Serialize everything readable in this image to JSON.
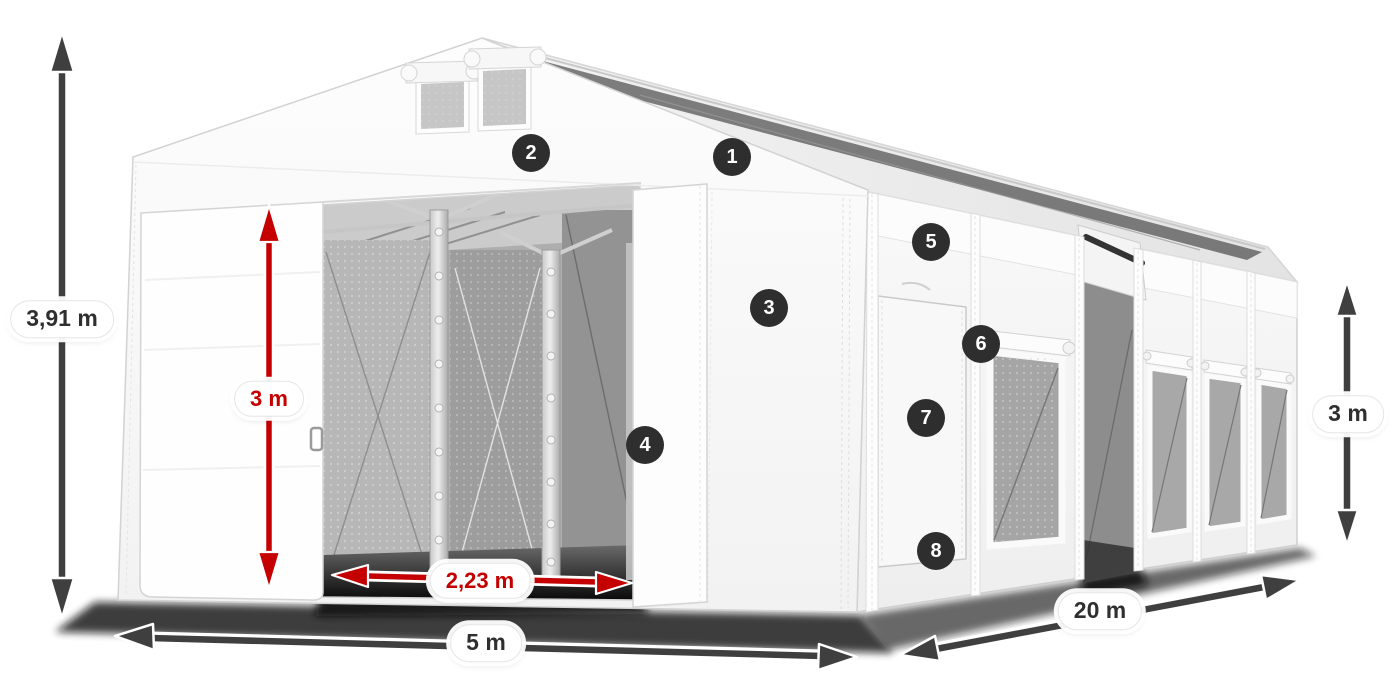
{
  "illustration": "White PVC storage tent (hala namiotowa) with open front gates, side door, mesh windows, dimension arrows and numbered feature markers",
  "colors": {
    "background": "#ffffff",
    "arrow_dark": "#3f3f3f",
    "arrow_red": "#c40000",
    "badge_background": "#2e2e2e",
    "badge_text": "#ffffff",
    "label_background": "#ffffff",
    "label_text_dark": "#2f2f2f",
    "label_text_red": "#c40000",
    "tent_fabric": "#f9f9f9",
    "mesh_gray": "#a5a5a5"
  },
  "dimensions": [
    {
      "id": "total-height",
      "value": "3,91 m",
      "style": "dark",
      "orientation": "vertical",
      "location": "far left, overall tent height"
    },
    {
      "id": "gate-height",
      "value": "3 m",
      "style": "red",
      "orientation": "vertical",
      "location": "front gate clear height"
    },
    {
      "id": "gate-width",
      "value": "2,23 m",
      "style": "red",
      "orientation": "horizontal",
      "location": "front gate clear width"
    },
    {
      "id": "front-width",
      "value": "5 m",
      "style": "dark",
      "orientation": "horizontal",
      "location": "front elevation width"
    },
    {
      "id": "side-length",
      "value": "20 m",
      "style": "dark",
      "orientation": "horizontal",
      "location": "side elevation length"
    },
    {
      "id": "side-height",
      "value": "3 m",
      "style": "dark",
      "orientation": "vertical",
      "location": "far right, side wall height"
    }
  ],
  "callouts": [
    {
      "number": "1",
      "location": "roof slope right of gable"
    },
    {
      "number": "2",
      "location": "gable above front gate"
    },
    {
      "number": "3",
      "location": "front right wall panel"
    },
    {
      "number": "4",
      "location": "front gate right post"
    },
    {
      "number": "5",
      "location": "side wall upper valance"
    },
    {
      "number": "6",
      "location": "side window rolled cover"
    },
    {
      "number": "7",
      "location": "side door panel upper"
    },
    {
      "number": "8",
      "location": "side door panel lower"
    }
  ]
}
